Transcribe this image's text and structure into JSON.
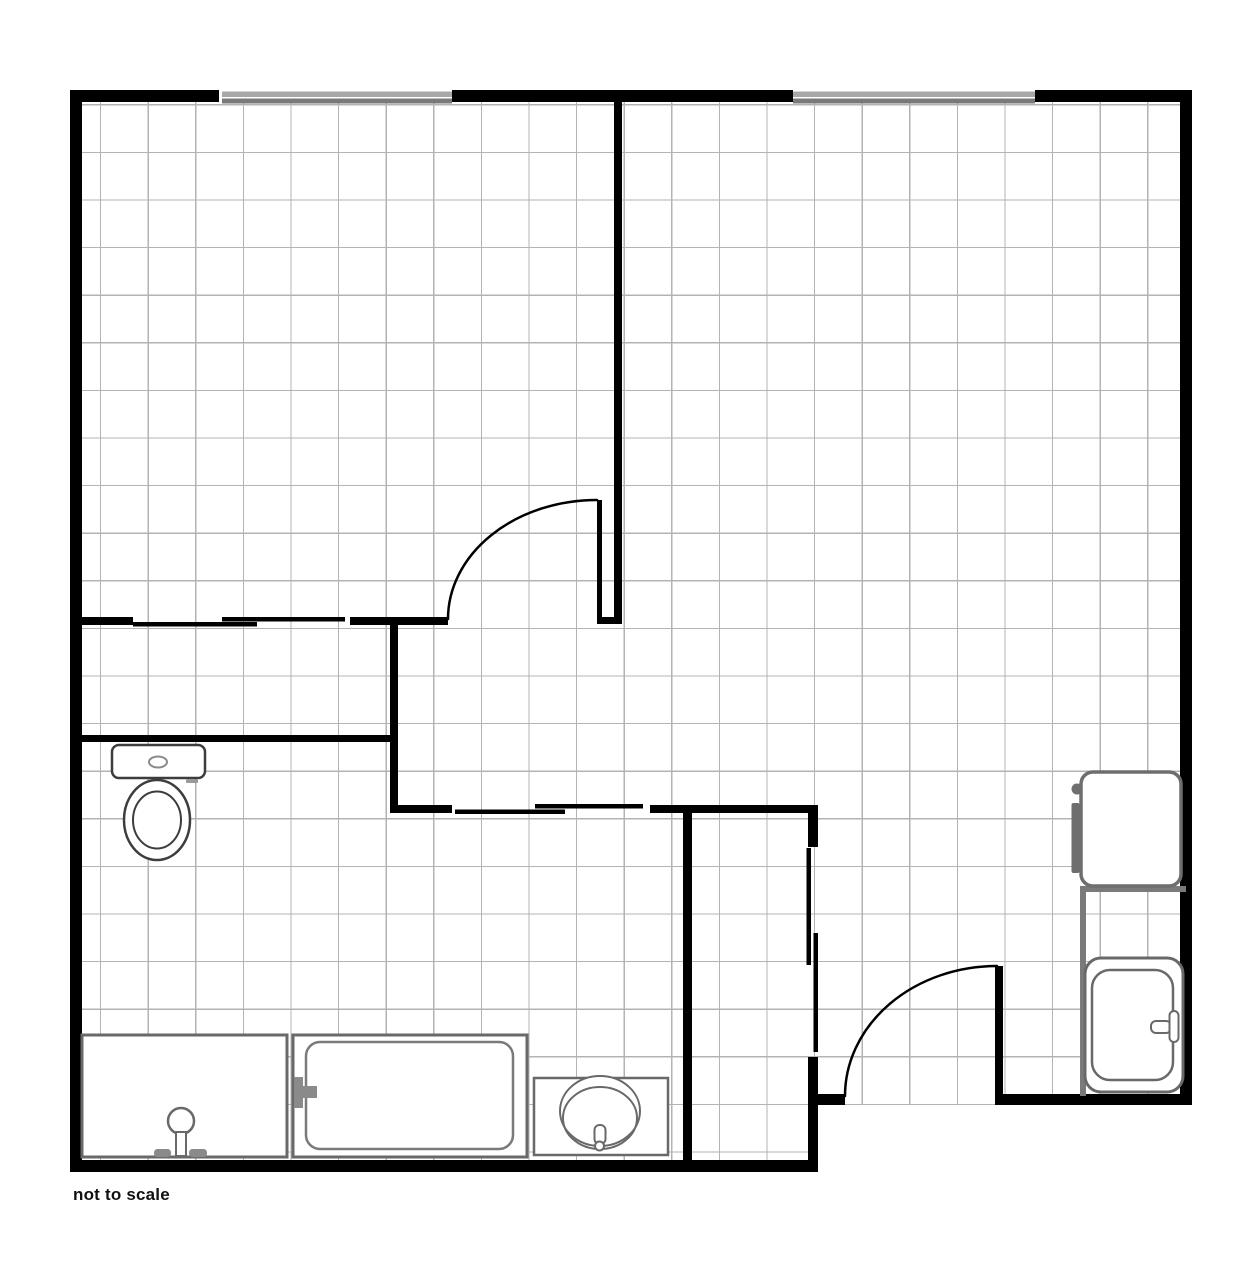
{
  "note": {
    "text": "not to scale"
  },
  "canvas": {
    "width": 1250,
    "height": 1277,
    "background": "#ffffff"
  },
  "colors": {
    "wall": "#000000",
    "grid": "#b3b3b3",
    "window_light": "#a8a8a8",
    "window_dark": "#7a7a7a",
    "fixture": "#696969",
    "fixture_dark": "#3d3d3d",
    "fixture_fill": "#8a8a8a",
    "partition": "#7a7a7a"
  },
  "grid": {
    "x": 82,
    "y": 102,
    "x2": 1180,
    "y2": 1160,
    "step": 47.6,
    "offset_x": 100.6,
    "offset_y": 104.8,
    "color": "#b3b3b3",
    "stroke_width": 1.25
  },
  "primitives": [
    {
      "name": "outside-mask-bottom-right",
      "type": "rect",
      "x": 818,
      "y": 1105,
      "w": 362,
      "h": 56,
      "fill": "#ffffff"
    },
    {
      "name": "window-top-left-outer-pane",
      "type": "rect",
      "x": 222,
      "y": 91.5,
      "w": 230,
      "h": 5.5,
      "fill": "#a8a8a8"
    },
    {
      "name": "window-top-left-inner-pane",
      "type": "rect",
      "x": 222,
      "y": 98.5,
      "w": 230,
      "h": 5,
      "fill": "#7a7a7a"
    },
    {
      "name": "window-top-right-outer-pane",
      "type": "rect",
      "x": 793,
      "y": 91.5,
      "w": 242,
      "h": 5.5,
      "fill": "#a8a8a8"
    },
    {
      "name": "window-top-right-inner-pane",
      "type": "rect",
      "x": 793,
      "y": 98.5,
      "w": 242,
      "h": 5,
      "fill": "#7a7a7a"
    },
    {
      "name": "wall-top-left",
      "type": "rect",
      "x": 70,
      "y": 90,
      "w": 149,
      "h": 12,
      "fill": "#000000"
    },
    {
      "name": "wall-top-middle",
      "type": "rect",
      "x": 452,
      "y": 90,
      "w": 341,
      "h": 12,
      "fill": "#000000"
    },
    {
      "name": "wall-top-right",
      "type": "rect",
      "x": 1035,
      "y": 90,
      "w": 157,
      "h": 12,
      "fill": "#000000"
    },
    {
      "name": "wall-left",
      "type": "rect",
      "x": 70,
      "y": 90,
      "w": 12,
      "h": 1082,
      "fill": "#000000"
    },
    {
      "name": "wall-right",
      "type": "rect",
      "x": 1180,
      "y": 90,
      "w": 12,
      "h": 1015,
      "fill": "#000000"
    },
    {
      "name": "wall-bottom-main",
      "type": "rect",
      "x": 70,
      "y": 1160,
      "w": 748,
      "h": 12,
      "fill": "#000000"
    },
    {
      "name": "wall-entry-left-stub",
      "type": "rect",
      "x": 808,
      "y": 1094,
      "w": 37,
      "h": 11,
      "fill": "#000000"
    },
    {
      "name": "wall-entry-right",
      "type": "rect",
      "x": 995,
      "y": 1094,
      "w": 197,
      "h": 11,
      "fill": "#000000"
    },
    {
      "name": "wall-entry-door-jamb",
      "type": "rect",
      "x": 995,
      "y": 966,
      "w": 8,
      "h": 130,
      "fill": "#000000"
    },
    {
      "name": "wall-core-vertical",
      "type": "rect",
      "x": 614,
      "y": 90,
      "w": 8,
      "h": 533,
      "fill": "#000000"
    },
    {
      "name": "wall-bedroom-door-jamb",
      "type": "rect",
      "x": 597,
      "y": 500,
      "w": 5,
      "h": 124,
      "fill": "#000000"
    },
    {
      "name": "wall-jamb-connector",
      "type": "rect",
      "x": 597,
      "y": 617,
      "w": 25,
      "h": 7,
      "fill": "#000000"
    },
    {
      "name": "wall-closet-left",
      "type": "rect",
      "x": 70,
      "y": 617,
      "w": 63,
      "h": 8,
      "fill": "#000000"
    },
    {
      "name": "wall-closet-right",
      "type": "rect",
      "x": 350,
      "y": 617,
      "w": 98,
      "h": 8,
      "fill": "#000000"
    },
    {
      "name": "sliding-door-closet-panel-a",
      "type": "rect",
      "x": 133,
      "y": 622,
      "w": 124,
      "h": 4.5,
      "fill": "#000000"
    },
    {
      "name": "sliding-door-closet-panel-b",
      "type": "rect",
      "x": 222,
      "y": 617,
      "w": 123,
      "h": 4.5,
      "fill": "#000000"
    },
    {
      "name": "wall-bathroom-top",
      "type": "rect",
      "x": 70,
      "y": 735,
      "w": 328,
      "h": 7,
      "fill": "#000000"
    },
    {
      "name": "wall-mid-vertical",
      "type": "rect",
      "x": 390,
      "y": 617,
      "w": 8,
      "h": 196,
      "fill": "#000000"
    },
    {
      "name": "wall-bathroom-right-seg-a",
      "type": "rect",
      "x": 392,
      "y": 805,
      "w": 60,
      "h": 8,
      "fill": "#000000"
    },
    {
      "name": "wall-bathroom-right-seg-b",
      "type": "rect",
      "x": 650,
      "y": 805,
      "w": 168,
      "h": 8,
      "fill": "#000000"
    },
    {
      "name": "sliding-door-bath-panel-a",
      "type": "rect",
      "x": 455,
      "y": 809.5,
      "w": 110,
      "h": 4.5,
      "fill": "#000000"
    },
    {
      "name": "sliding-door-bath-panel-b",
      "type": "rect",
      "x": 535,
      "y": 804,
      "w": 108,
      "h": 4.5,
      "fill": "#000000"
    },
    {
      "name": "wall-hall-left",
      "type": "rect",
      "x": 683,
      "y": 805,
      "w": 9,
      "h": 367,
      "fill": "#000000"
    },
    {
      "name": "wall-hall-right-top-stub",
      "type": "rect",
      "x": 808,
      "y": 805,
      "w": 10,
      "h": 42,
      "fill": "#000000"
    },
    {
      "name": "wall-hall-right-bottom-stub",
      "type": "rect",
      "x": 808,
      "y": 1057,
      "w": 10,
      "h": 115,
      "fill": "#000000"
    },
    {
      "name": "sliding-door-hall-panel-a",
      "type": "rect",
      "x": 806.5,
      "y": 848,
      "w": 4.5,
      "h": 117,
      "fill": "#000000"
    },
    {
      "name": "sliding-door-hall-panel-b",
      "type": "rect",
      "x": 813.5,
      "y": 933,
      "w": 4.5,
      "h": 119,
      "fill": "#000000"
    },
    {
      "name": "door-swing-arc-bedroom",
      "type": "path",
      "d": "M 448 619 A 149 119 0 0 1 597 500",
      "stroke": "#000000",
      "sw": 2.5
    },
    {
      "name": "door-swing-arc-entry",
      "type": "path",
      "d": "M 845 1096 A 152 130 0 0 1 997 966",
      "stroke": "#000000",
      "sw": 2.5
    },
    {
      "name": "partition-shower-room-top",
      "type": "rect",
      "x": 1080,
      "y": 886,
      "w": 106,
      "h": 6,
      "fill": "#7a7a7a"
    },
    {
      "name": "partition-shower-room-left",
      "type": "rect",
      "x": 1080,
      "y": 886,
      "w": 6,
      "h": 210,
      "fill": "#7a7a7a"
    },
    {
      "name": "washer-door-bar",
      "type": "rect",
      "x": 1071.5,
      "y": 803,
      "w": 8,
      "h": 70,
      "rx": 2,
      "fill": "#6e6e6e"
    },
    {
      "name": "washer-knob",
      "type": "circle",
      "cx": 1077,
      "cy": 789,
      "r": 5.5,
      "fill": "#6e6e6e"
    },
    {
      "name": "washer-body",
      "type": "rect",
      "x": 1081,
      "y": 772,
      "w": 100,
      "h": 114,
      "rx": 12,
      "fill": "#ffffff",
      "stroke": "#6e6e6e",
      "sw": 3.5
    },
    {
      "name": "shower-enclosure",
      "type": "rect",
      "x": 1085,
      "y": 958,
      "w": 98,
      "h": 134,
      "rx": 16,
      "fill": "#ffffff",
      "stroke": "#696969",
      "sw": 3
    },
    {
      "name": "shower-tray",
      "type": "rect",
      "x": 1092,
      "y": 970,
      "w": 81,
      "h": 110,
      "rx": 18,
      "fill": "#ffffff",
      "stroke": "#696969",
      "sw": 2.5
    },
    {
      "name": "shower-handle-horizontal",
      "type": "rect",
      "x": 1151,
      "y": 1021,
      "w": 20,
      "h": 12,
      "rx": 5,
      "fill": "#ffffff",
      "stroke": "#696969",
      "sw": 2
    },
    {
      "name": "shower-handle-vertical",
      "type": "rect",
      "x": 1169.5,
      "y": 1011,
      "w": 9,
      "h": 31,
      "rx": 4.5,
      "fill": "#ffffff",
      "stroke": "#696969",
      "sw": 2
    },
    {
      "name": "toilet-tank",
      "type": "rect",
      "x": 112,
      "y": 745,
      "w": 93,
      "h": 33,
      "rx": 7,
      "fill": "#ffffff",
      "stroke": "#3d3d3d",
      "sw": 2.5
    },
    {
      "name": "toilet-flush-button",
      "type": "ellipse",
      "cx": 158,
      "cy": 762,
      "rx": 9,
      "ry": 5.5,
      "fill": "#ffffff",
      "stroke": "#8a8a8a",
      "sw": 2
    },
    {
      "name": "toilet-hinge-mark",
      "type": "rect",
      "x": 186,
      "y": 779.5,
      "w": 12,
      "h": 3.5,
      "rx": 1,
      "fill": "#999999"
    },
    {
      "name": "toilet-bowl-outer",
      "type": "ellipse",
      "cx": 157,
      "cy": 820,
      "rx": 33,
      "ry": 40,
      "fill": "#ffffff",
      "stroke": "#3d3d3d",
      "sw": 2.5
    },
    {
      "name": "toilet-bowl-inner",
      "type": "ellipse",
      "cx": 157,
      "cy": 820,
      "rx": 24,
      "ry": 28.5,
      "fill": "none",
      "stroke": "#3d3d3d",
      "sw": 2
    },
    {
      "name": "vanity-counter",
      "type": "rect",
      "x": 82,
      "y": 1035,
      "w": 205,
      "h": 122,
      "fill": "#ffffff",
      "stroke": "#696969",
      "sw": 3
    },
    {
      "name": "vanity-faucet-head",
      "type": "circle",
      "cx": 181,
      "cy": 1121,
      "r": 13,
      "fill": "#ffffff",
      "stroke": "#696969",
      "sw": 2.5
    },
    {
      "name": "vanity-faucet-stem",
      "type": "rect",
      "x": 176,
      "y": 1132,
      "w": 10,
      "h": 24,
      "fill": "#ffffff",
      "stroke": "#696969",
      "sw": 2
    },
    {
      "name": "vanity-handle-left",
      "type": "rect",
      "x": 154,
      "y": 1149,
      "w": 17,
      "h": 8,
      "rx": 3.5,
      "fill": "#8a8a8a"
    },
    {
      "name": "vanity-handle-right",
      "type": "rect",
      "x": 189,
      "y": 1149,
      "w": 18,
      "h": 8,
      "rx": 3.5,
      "fill": "#8a8a8a"
    },
    {
      "name": "bathtub-outer",
      "type": "rect",
      "x": 293,
      "y": 1035,
      "w": 234,
      "h": 122,
      "fill": "#ffffff",
      "stroke": "#696969",
      "sw": 3
    },
    {
      "name": "bathtub-basin",
      "type": "rect",
      "x": 306,
      "y": 1042,
      "w": 207,
      "h": 107,
      "rx": 14,
      "fill": "#ffffff",
      "stroke": "#7a7a7a",
      "sw": 2.5
    },
    {
      "name": "bathtub-faucet-bar",
      "type": "rect",
      "x": 294,
      "y": 1077,
      "w": 9,
      "h": 31,
      "fill": "#8a8a8a"
    },
    {
      "name": "bathtub-faucet-spout",
      "type": "rect",
      "x": 303,
      "y": 1086,
      "w": 14,
      "h": 12,
      "fill": "#8a8a8a"
    },
    {
      "name": "sink-counter",
      "type": "rect",
      "x": 534,
      "y": 1078,
      "w": 134,
      "h": 77,
      "fill": "#ffffff",
      "stroke": "#696969",
      "sw": 2.5
    },
    {
      "name": "sink-bowl-rim",
      "type": "ellipse",
      "cx": 600,
      "cy": 1111,
      "rx": 40,
      "ry": 35,
      "fill": "#ffffff",
      "stroke": "#696969",
      "sw": 2
    },
    {
      "name": "sink-bowl-inner",
      "type": "ellipse",
      "cx": 600,
      "cy": 1118,
      "rx": 37,
      "ry": 31,
      "fill": "none",
      "stroke": "#696969",
      "sw": 2
    },
    {
      "name": "sink-faucet",
      "type": "rect",
      "x": 594.5,
      "y": 1125,
      "w": 11,
      "h": 19,
      "rx": 5,
      "fill": "#ffffff",
      "stroke": "#696969",
      "sw": 2
    },
    {
      "name": "sink-drain",
      "type": "circle",
      "cx": 599.5,
      "cy": 1146,
      "r": 4.5,
      "fill": "#ffffff",
      "stroke": "#696969",
      "sw": 2
    }
  ]
}
